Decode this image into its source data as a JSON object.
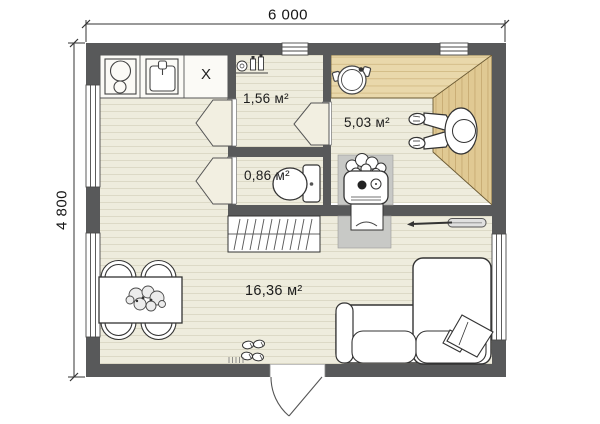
{
  "dimension_labels": {
    "width": "6 000",
    "height": "4 800"
  },
  "room_areas": {
    "entry": "1,56 м²",
    "steam": "5,03 м²",
    "wc": "0,86 м²",
    "living": "16,36 м²"
  },
  "kitchen": {
    "cabinet_label": "X"
  },
  "colors": {
    "wall": "#58595a",
    "floor": "#eeecdd",
    "plank_line": "#dcd9c6",
    "bench_light": "#e9d8ab",
    "bench_wood": "#e0c993",
    "stove_platform": "#c8c9c6",
    "outline": "#333333",
    "background": "#ffffff"
  },
  "fixtures": {
    "kitchen_zone": [
      "cooktop-icon",
      "sink-icon",
      "cabinet-x-icon"
    ],
    "entry_room": [
      "toiletry-shelf-icon",
      "window-icon"
    ],
    "steam_room": [
      "bucket-icon",
      "sauna-stove-icon",
      "person-figure-icon",
      "sauna-bench-icon"
    ],
    "wc_room": [
      "toilet-icon"
    ],
    "living_room": [
      "coat-rack-icon",
      "dining-table-icon",
      "chair-icon",
      "plant-icon",
      "corner-sofa-icon",
      "pillow-icon",
      "shoes-icon",
      "entry-door-icon",
      "ladle-icon"
    ]
  }
}
